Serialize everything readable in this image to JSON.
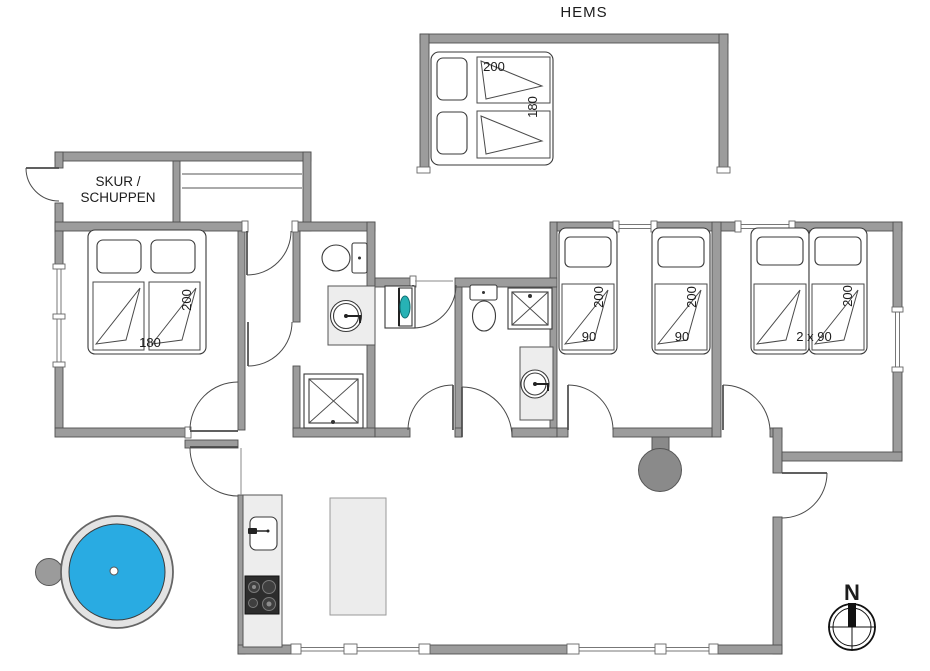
{
  "labels": {
    "hems": "HEMS",
    "shed_line1": "SKUR /",
    "shed_line2": "SCHUPPEN",
    "north": "N"
  },
  "dimensions": {
    "hems_bed": {
      "length": "200",
      "width": "180"
    },
    "double_bed": {
      "width": "180",
      "length": "200"
    },
    "single_bed_1": {
      "width": "90",
      "length": "200"
    },
    "single_bed_2": {
      "width": "90",
      "length": "200"
    },
    "twin_bed": {
      "width": "2 x 90",
      "length": "200"
    }
  },
  "colors": {
    "wall": "#9c9c9c",
    "wall_outline": "#4f4f4f",
    "hot_tub_water": "#29abe2",
    "wood_stove": "#8a8a8a",
    "hob": "#2d2d2d",
    "counter": "#ededed",
    "washer_door": "#27b2b5",
    "line": "#3a3a3a"
  }
}
